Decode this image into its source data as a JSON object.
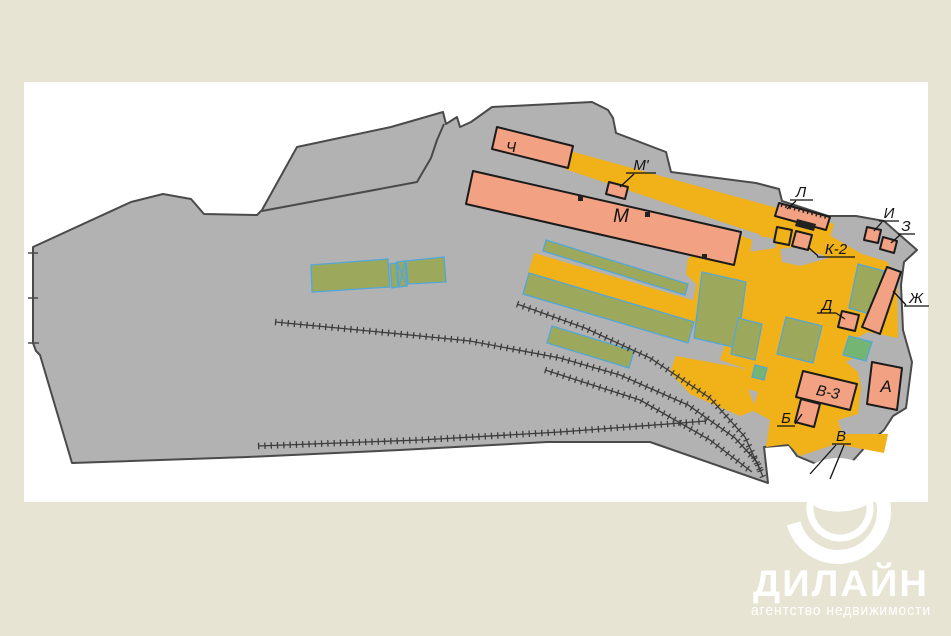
{
  "page": {
    "background": "#e8e4d3",
    "card_background": "#ffffff"
  },
  "map": {
    "colors": {
      "parcel": "#b2b2b2",
      "parcel_outline": "#4a4a4a",
      "building": "#f2a282",
      "building_outline": "#1b1b1b",
      "road": "#f1b118",
      "green": "#9ca85b",
      "green_outline": "#53a7d8",
      "green_alt": "#74b573",
      "structure_dark": "#222222",
      "track": "#3c3c3c",
      "label": "#111111"
    },
    "labels": {
      "ch": "Ч",
      "m_prime": "М'",
      "m": "М",
      "l": "Л",
      "k2": "К-2",
      "i": "И",
      "z": "З",
      "zh": "Ж",
      "d": "Д",
      "a": "А",
      "v3": "В-3",
      "b": "Б",
      "v": "В"
    }
  },
  "logo": {
    "name": "ДИЛАЙН",
    "tagline": "агентство недвижимости",
    "color": "#ffffff"
  }
}
